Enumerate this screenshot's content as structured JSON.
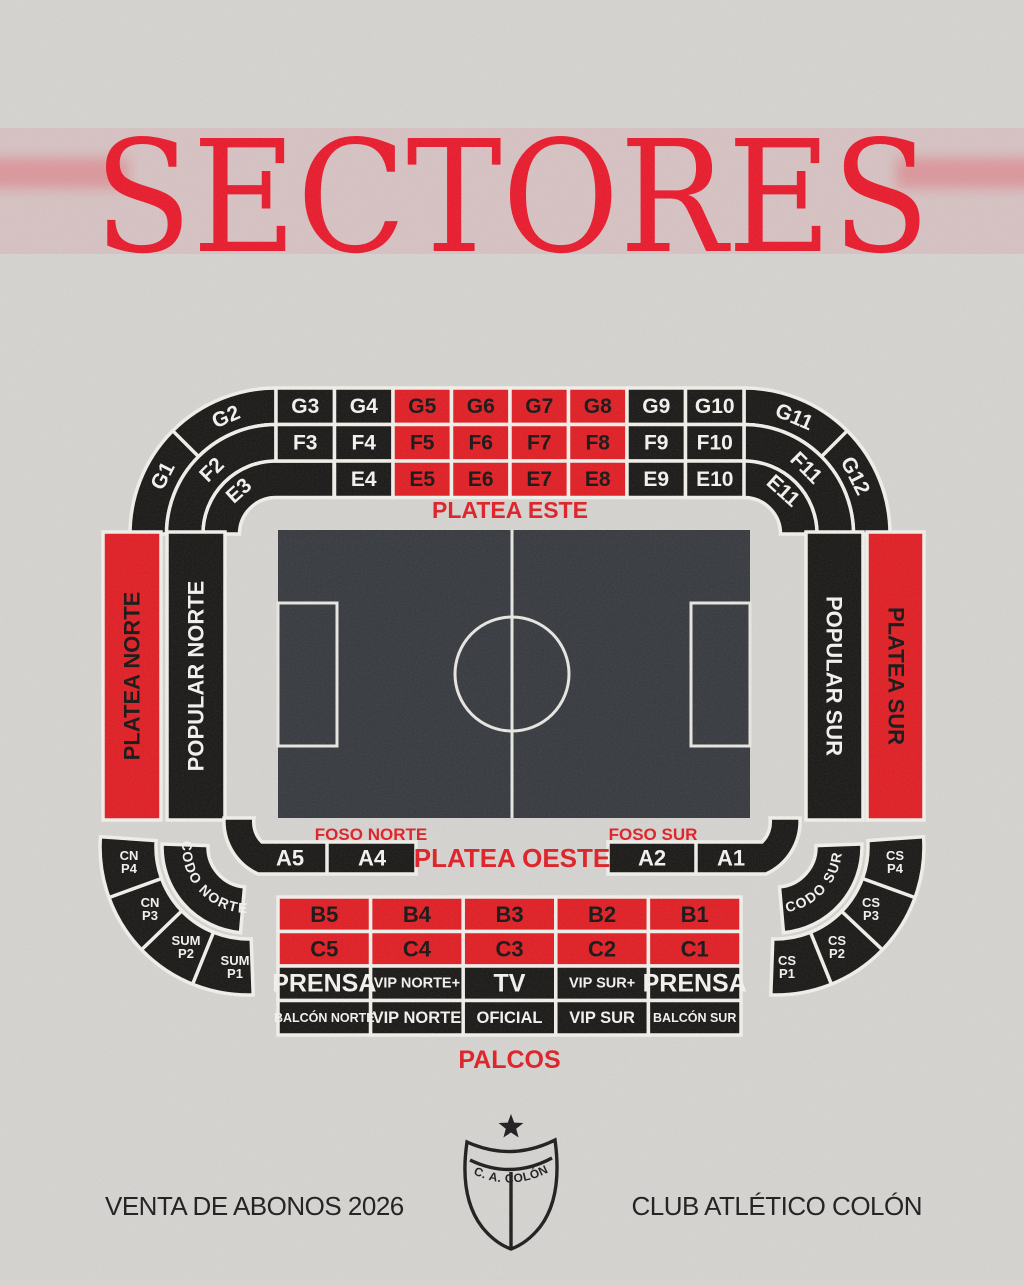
{
  "title": "SECTORES",
  "colors": {
    "background": "#d6d4d1",
    "red": "#e01d23",
    "black": "#181715",
    "pitch": "#35383d",
    "line_white": "#f2f0ea",
    "label_on_black": "#f5f3ef",
    "label_on_red": "#141414",
    "title_red": "#e9192b",
    "ink": "#1b1b1b"
  },
  "map": {
    "east_stand": {
      "label": "PLATEA ESTE",
      "row_g": [
        "G3",
        "G4",
        "G5",
        "G6",
        "G7",
        "G8",
        "G9",
        "G10"
      ],
      "row_f": [
        "F3",
        "F4",
        "F5",
        "F6",
        "F7",
        "F8",
        "F9",
        "F10"
      ],
      "row_e": [
        "E4",
        "E5",
        "E6",
        "E7",
        "E8",
        "E9",
        "E10"
      ],
      "corner_left": {
        "g1": "G1",
        "g2": "G2",
        "f2": "F2",
        "e3": "E3"
      },
      "corner_right": {
        "g11": "G11",
        "g12": "G12",
        "f11": "F11",
        "e11": "E11"
      }
    },
    "sides": {
      "platea_norte": "PLATEA NORTE",
      "popular_norte": "POPULAR NORTE",
      "popular_sur": "POPULAR SUR",
      "platea_sur": "PLATEA SUR"
    },
    "west_stand": {
      "foso_norte": "FOSO NORTE",
      "foso_sur": "FOSO SUR",
      "label": "PLATEA OESTE",
      "row_a": [
        "A5",
        "A4",
        "A2",
        "A1"
      ],
      "row_b": [
        "B5",
        "B4",
        "B3",
        "B2",
        "B1"
      ],
      "row_c": [
        "C5",
        "C4",
        "C3",
        "C2",
        "C1"
      ],
      "row_boxes": [
        "PRENSA",
        "VIP NORTE+",
        "TV",
        "VIP SUR+",
        "PRENSA"
      ],
      "row_balcony": [
        "BALCÓN NORTE",
        "VIP NORTE",
        "OFICIAL",
        "VIP SUR",
        "BALCÓN SUR"
      ],
      "palcos": "PALCOS"
    },
    "corner_fans": {
      "left": {
        "codo": "CODO NORTE",
        "wedges": [
          {
            "l1": "CN",
            "l2": "P4"
          },
          {
            "l1": "CN",
            "l2": "P3"
          },
          {
            "l1": "SUM",
            "l2": "P2"
          },
          {
            "l1": "SUM",
            "l2": "P1"
          }
        ]
      },
      "right": {
        "codo": "CODO SUR",
        "wedges": [
          {
            "l1": "CS",
            "l2": "P4"
          },
          {
            "l1": "CS",
            "l2": "P3"
          },
          {
            "l1": "CS",
            "l2": "P2"
          },
          {
            "l1": "CS",
            "l2": "P1"
          }
        ]
      }
    }
  },
  "footer": {
    "left": "VENTA DE ABONOS 2026",
    "right": "CLUB ATLÉTICO COLÓN",
    "crest_text": "C. A. COLÓN"
  }
}
